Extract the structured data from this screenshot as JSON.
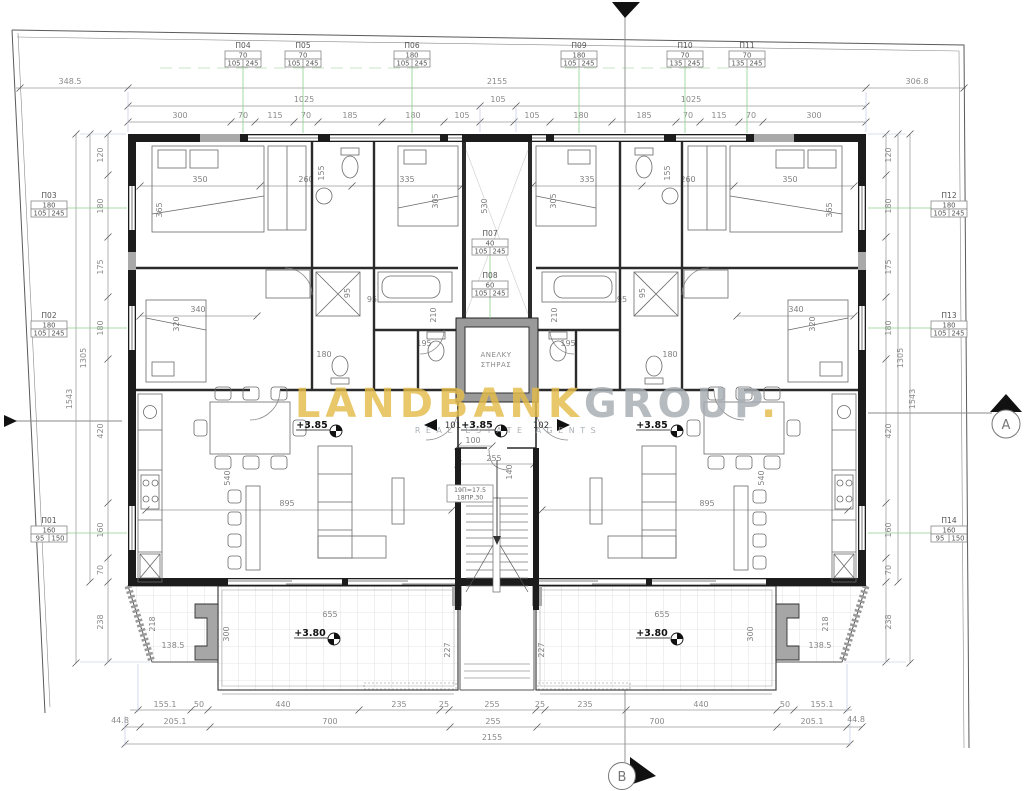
{
  "watermark": {
    "brand_gold": "LANDBANK",
    "brand_gray": "GROUP",
    "brand_dot": ".",
    "subtitle": "REAL ESTATE AGENTS",
    "gold_color": "#e4bc4a",
    "gray_color": "#a7adb3"
  },
  "markers": {
    "section_a": "A",
    "section_b": "B"
  },
  "core": {
    "elevator_line1": "ΑΝΕΛΚΥ",
    "elevator_line2": "ΣΤΗΡΑΣ",
    "stair_note1": "19Π=17.5",
    "stair_note2": "18ΠΡ.30",
    "unit_left": "101",
    "unit_right": "102"
  },
  "levels": {
    "floor": "+3.85",
    "balcony": "+3.80"
  },
  "window_labels": {
    "p01": {
      "name": "Π01",
      "w": "160",
      "s1": "95",
      "s2": "150"
    },
    "p02": {
      "name": "Π02",
      "w": "180",
      "s1": "105",
      "s2": "245"
    },
    "p03": {
      "name": "Π03",
      "w": "180",
      "s1": "105",
      "s2": "245"
    },
    "p04": {
      "name": "Π04",
      "w": "70",
      "s1": "105",
      "s2": "245"
    },
    "p05": {
      "name": "Π05",
      "w": "70",
      "s1": "105",
      "s2": "245"
    },
    "p06": {
      "name": "Π06",
      "w": "180",
      "s1": "105",
      "s2": "245"
    },
    "p07": {
      "name": "Π07",
      "w": "40",
      "s1": "105",
      "s2": "245"
    },
    "p08": {
      "name": "Π08",
      "w": "60",
      "s1": "105",
      "s2": "245"
    },
    "p09": {
      "name": "Π09",
      "w": "180",
      "s1": "105",
      "s2": "245"
    },
    "p10": {
      "name": "Π10",
      "w": "70",
      "s1": "135",
      "s2": "245"
    },
    "p11": {
      "name": "Π11",
      "w": "70",
      "s1": "135",
      "s2": "245"
    },
    "p12": {
      "name": "Π12",
      "w": "180",
      "s1": "105",
      "s2": "245"
    },
    "p13": {
      "name": "Π13",
      "w": "180",
      "s1": "105",
      "s2": "245"
    },
    "p14": {
      "name": "Π14",
      "w": "160",
      "s1": "95",
      "s2": "150"
    }
  },
  "dims": {
    "top1": {
      "left": "348.5",
      "total": "2155",
      "right": "306.8"
    },
    "top2": [
      "1025",
      "105",
      "1025"
    ],
    "top3": [
      "300",
      "70",
      "115",
      "70",
      "185",
      "180",
      "105",
      "105",
      "180",
      "185",
      "70",
      "115",
      "70",
      "300"
    ],
    "sidecol": [
      "120",
      "180",
      "175",
      "180",
      "420",
      "160",
      "70",
      "238"
    ],
    "side_1305": "1305",
    "side_1543": "1543",
    "bottom1": [
      "155.1",
      "50",
      "440",
      "235",
      "25",
      "255",
      "25",
      "235",
      "440",
      "50",
      "155.1"
    ],
    "bottom2": [
      "44.8",
      "205.1",
      "700",
      "255",
      "700",
      "205.1",
      "44.8"
    ],
    "bottom_total": "2155",
    "rooms": {
      "bed_master": "350",
      "bed_master_depth": "365",
      "bath": "260",
      "bath_depth": "155",
      "bed_small": "335",
      "bed_small_depth": "305",
      "bed_third": "340",
      "bed_third_depth": "320",
      "bath_inner": "180",
      "tub_len": "195",
      "tub_depth": "210",
      "gap95": "95",
      "living": "895",
      "living_depth": "540",
      "shaft_height": "530",
      "elev_width": "185",
      "hall": "100",
      "lobby": "255",
      "lobby_depth": "140",
      "court": "227"
    },
    "balcony": {
      "width": "655",
      "depth": "300",
      "side": "218",
      "inset": "138.5",
      "edge": "173"
    }
  }
}
